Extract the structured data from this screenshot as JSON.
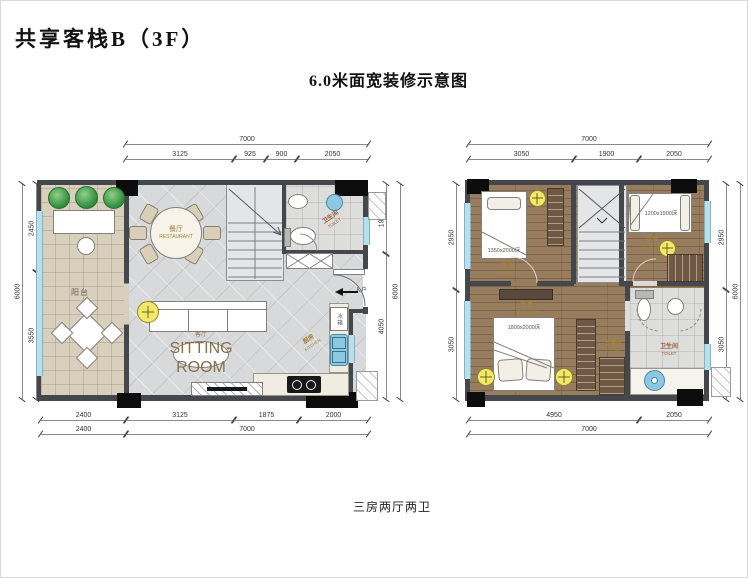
{
  "page": {
    "title": "共享客栈B（3F）",
    "subtitle": "6.0米面宽装修示意图",
    "caption": "三房两厅两卫"
  },
  "colors": {
    "wall": "#44474b",
    "column": "#0c0c0c",
    "window": "#b8e0ec",
    "floor_tile": "#d7d9db",
    "floor_wood": "#977c5e",
    "balcony_floor": "#d9cfbd",
    "label_gold": "#a4833c",
    "plant_green": "#2f8c3d",
    "ceiling_light": "#f2e96a",
    "sink_blue": "#8cc8e2"
  },
  "planL": {
    "dims": {
      "top_total": "7000",
      "top_segs": [
        "3125",
        "925",
        "900",
        "2050"
      ],
      "left_total": "6000",
      "left_segs": [
        "2450",
        "3550"
      ],
      "right_total": "6000",
      "right_segs": [
        "1950",
        "4050"
      ],
      "bottom_row1": [
        "2400",
        "3125",
        "1875",
        "2000"
      ],
      "bottom_row2": [
        "2400",
        "7000"
      ]
    },
    "rooms": {
      "balcony": "阳台",
      "dining_cn": "餐厅",
      "dining_en": "RESTAURANT",
      "living_cn": "客厅",
      "living_en": "SITTING ROOM",
      "kitchen_cn": "厨房",
      "kitchen_en": "KITCHEN",
      "toilet_cn": "卫生间",
      "toilet_en": "TOILET",
      "fridge": "冰箱",
      "entry": "入户"
    }
  },
  "planR": {
    "dims": {
      "top_total": "7000",
      "top_segs": [
        "3050",
        "1900",
        "2050"
      ],
      "left_segs": [
        "2950",
        "3050"
      ],
      "right_total": "6000",
      "right_segs": [
        "2950",
        "3050"
      ],
      "bottom_total": "7000",
      "bottom_segs": [
        "4950",
        "2050"
      ]
    },
    "rooms": {
      "bed1_cn": "卧室",
      "bed1_en": "BEDROOM",
      "bed1_size": "1350x2000床",
      "bed2_cn": "卧室",
      "bed2_en": "BEDROOM",
      "bed2_size": "1200x1900床",
      "bed3_cn": "卧室",
      "bed3_en": "BEDROOM",
      "bed3_size": "1800x2000床",
      "cloak_cn": "衣帽间",
      "cloak_en": "CLOAK",
      "toilet_cn": "卫生间",
      "toilet_en": "TOILET"
    }
  }
}
